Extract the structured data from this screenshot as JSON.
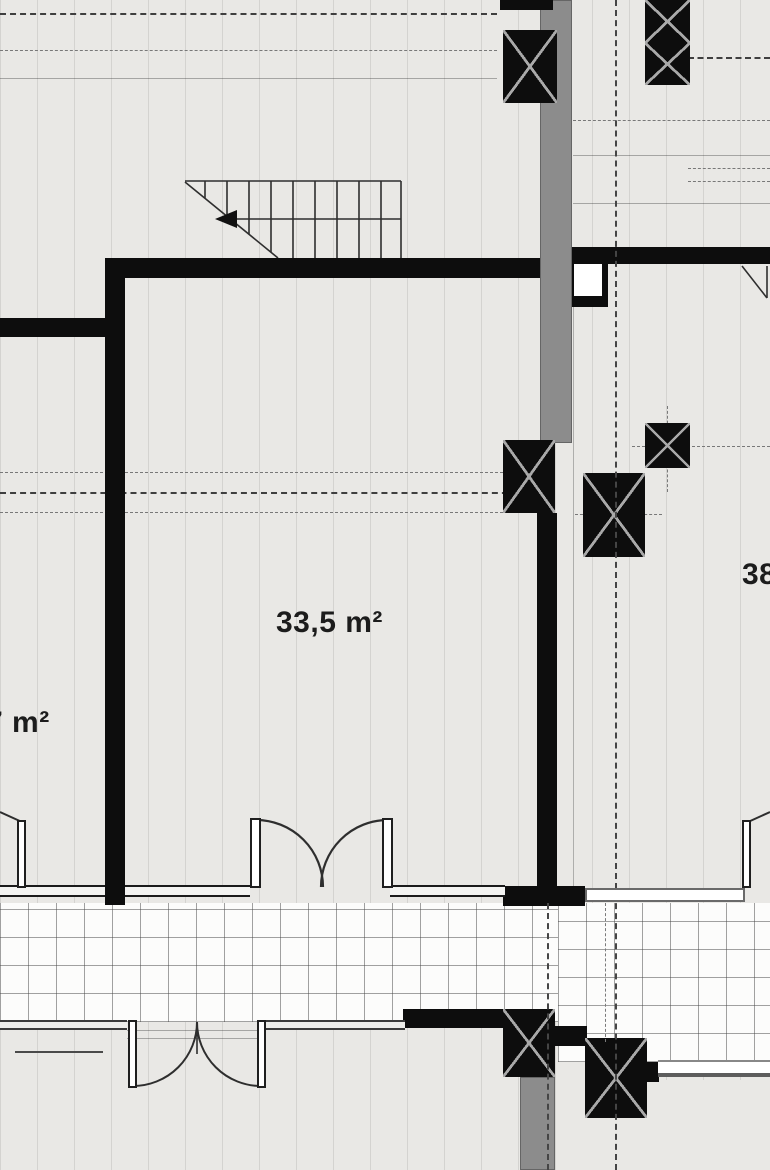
{
  "meta": {
    "kind": "architectural floor plan section, upper-floor apartment plan"
  },
  "labels": {
    "room_center_area": "33,5 m²",
    "room_left_area": "7 m²",
    "room_right_area": "38"
  },
  "colors": {
    "floor": "#e9e8e5",
    "wall": "#0d0d0d",
    "concrete_gray": "#8c8c8c",
    "tile_background": "#fcfcfb",
    "line_dark": "#3a3a3a",
    "text": "#1c1c1c"
  },
  "features": {
    "stairs": "stair run with break line and direction arrow",
    "columns": "structural columns with X cross marks",
    "terrace": "tiled terrace strip",
    "doors": "double swing doors and single swing doors",
    "axes": "dash-dot structural axis lines"
  }
}
